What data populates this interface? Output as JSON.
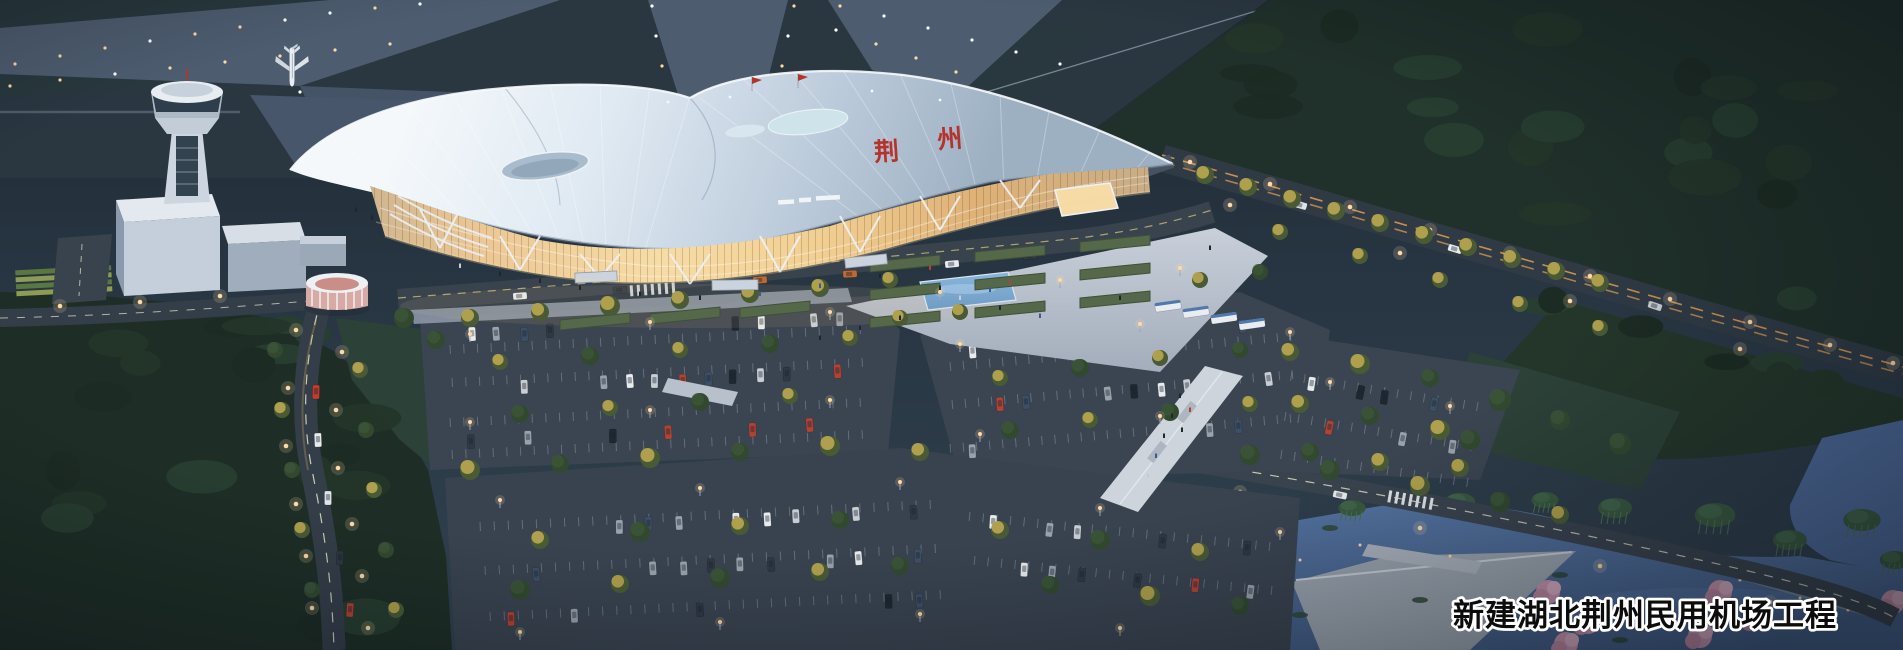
{
  "scene": {
    "title": "新建湖北荆州民用机场工程",
    "terminal_sign": {
      "char1": "荆",
      "char2": "州"
    },
    "colors": {
      "sky_top": "#1e2933",
      "sky_mid": "#283643",
      "ground": "#2f3f4b",
      "airfield": "#2a3640",
      "taxiway": "#4d5c6f",
      "apron": "#47566a",
      "forest_dark": "#1c2b23",
      "forest_mid": "#243629",
      "tree_lit": "#b3a44e",
      "tree_green": "#3c5238",
      "roof_light": "#f4f8fb",
      "roof_mid": "#ccd9e6",
      "roof_shadow": "#9fb1c3",
      "glass_warm": "#f6d9a4",
      "glass_deep": "#dfab6e",
      "red_accent": "#b5332a",
      "plaza": "#b9c2cf",
      "walkway": "#cdd4dc",
      "road": "#39434e",
      "road_dark": "#2f3a44",
      "lane_amber": "#dfa055",
      "water": "#4f6b9c",
      "water_light": "#5d7bb0",
      "deck": "#9aa3ae",
      "blossom": "#c995ad",
      "lamp": "#ffd9a6",
      "white": "#e9edf2",
      "caption_fill": "#0c0c0c",
      "caption_stroke": "#ffffff"
    }
  }
}
